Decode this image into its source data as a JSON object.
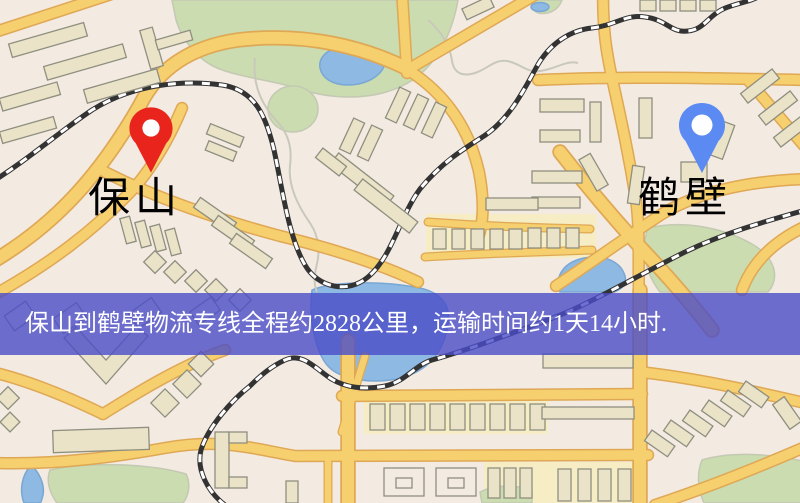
{
  "banner": {
    "text": "保山到鹤壁物流专线全程约2828公里，运输时间约1天14小时.",
    "bg_color": "#4a4cc8",
    "text_color": "#ffffff"
  },
  "markers": {
    "origin": {
      "name": "保山",
      "icon": "map-pin",
      "pin_color": "#e8241d",
      "label_color": "#e60000"
    },
    "destination": {
      "name": "鹤壁",
      "icon": "map-pin",
      "pin_color": "#5b8bf2",
      "label_color": "#2433d8"
    }
  },
  "map": {
    "colors": {
      "background": "#f3eae2",
      "road": "#f6cf6e",
      "road_casing": "#dfa855",
      "water": "#8db9e2",
      "park": "#cbdcb0",
      "building": "#eae3c8",
      "building_outline": "#8f8f80",
      "railway": "#333333",
      "block": "#f6edc4"
    }
  }
}
